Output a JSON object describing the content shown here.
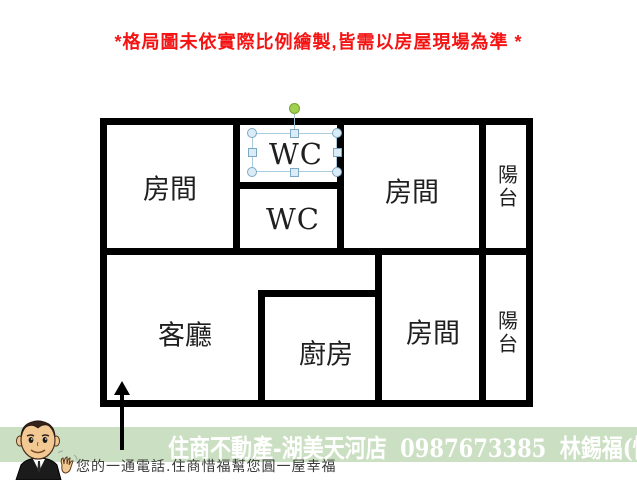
{
  "warning": {
    "text": "*格局圖未依實際比例繪製,皆需以房屋現場為準 *"
  },
  "floor_plan": {
    "rooms": [
      {
        "id": "bedroom-top-left",
        "label": "房間"
      },
      {
        "id": "wc-top",
        "label": "WC"
      },
      {
        "id": "bedroom-top-right",
        "label": "房間"
      },
      {
        "id": "balcony-top",
        "label": "陽台"
      },
      {
        "id": "wc-bottom",
        "label": "WC"
      },
      {
        "id": "living-room",
        "label": "客廳"
      },
      {
        "id": "kitchen",
        "label": "廚房"
      },
      {
        "id": "bedroom-bottom-right",
        "label": "房間"
      },
      {
        "id": "balcony-bottom",
        "label": "陽台"
      }
    ]
  },
  "banner": {
    "store": "住商不動產-湖美天河店",
    "phone": "0987673385",
    "agent": "林錫福(惜福)",
    "tagline": "您的一通電話.住商惜福幫您圓一屋幸福"
  },
  "colors": {
    "warning_red": "#f41414",
    "wall_black": "#000000",
    "banner_green": "#cbdfc2",
    "banner_text": "#ffffff",
    "selection_line": "#a9cce0",
    "handle_fill": "#d9ecf7",
    "handle_stroke": "#7fa9c2",
    "rotate_handle_green": "#9fd050"
  }
}
